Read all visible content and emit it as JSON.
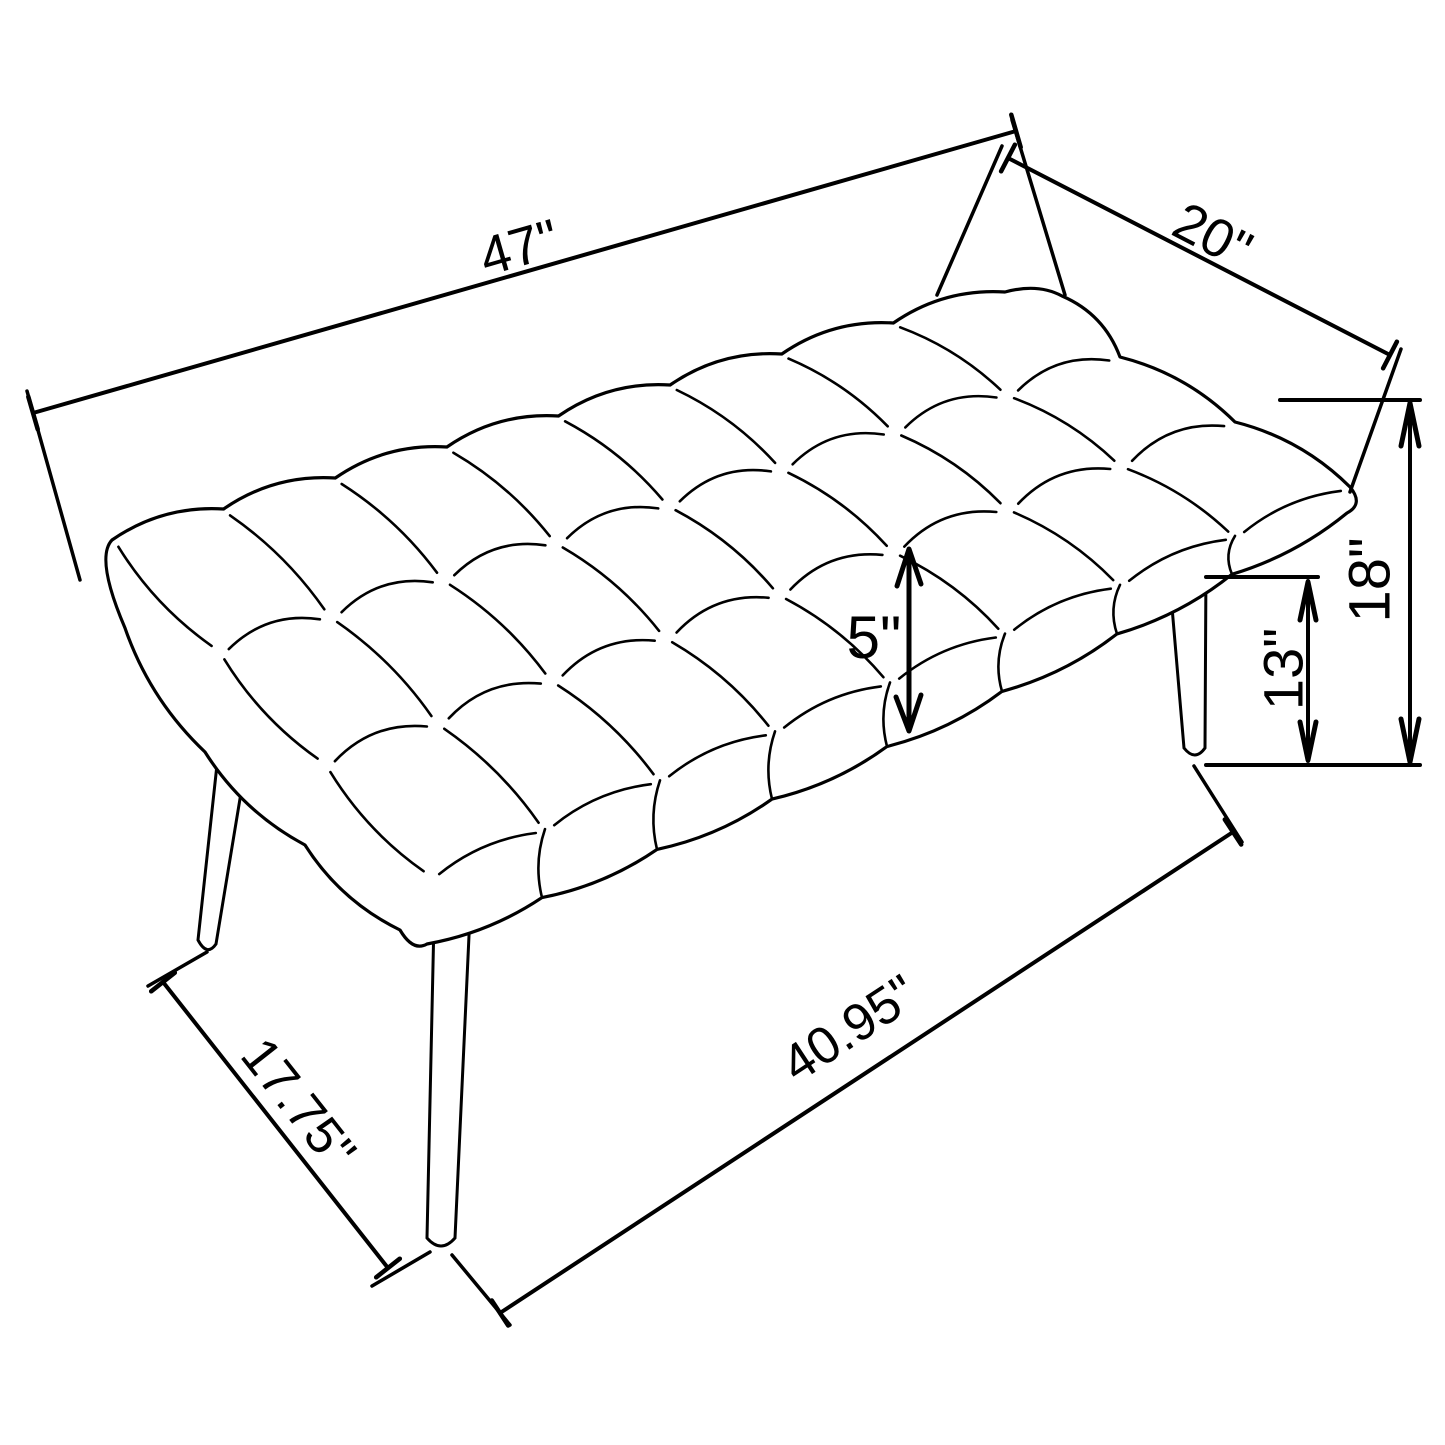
{
  "meta": {
    "background": "#ffffff",
    "ink_color": "#000000",
    "drawing_type": "furniture dimension line drawing",
    "subject": "tufted bench with splayed legs"
  },
  "dimensions": {
    "overall_length": "47\"",
    "overall_depth": "20\"",
    "cushion_thickness": "5\"",
    "overall_height": "18\"",
    "leg_height": "13\"",
    "leg_span_side": "17.75\"",
    "leg_span_front": "40.95\""
  }
}
